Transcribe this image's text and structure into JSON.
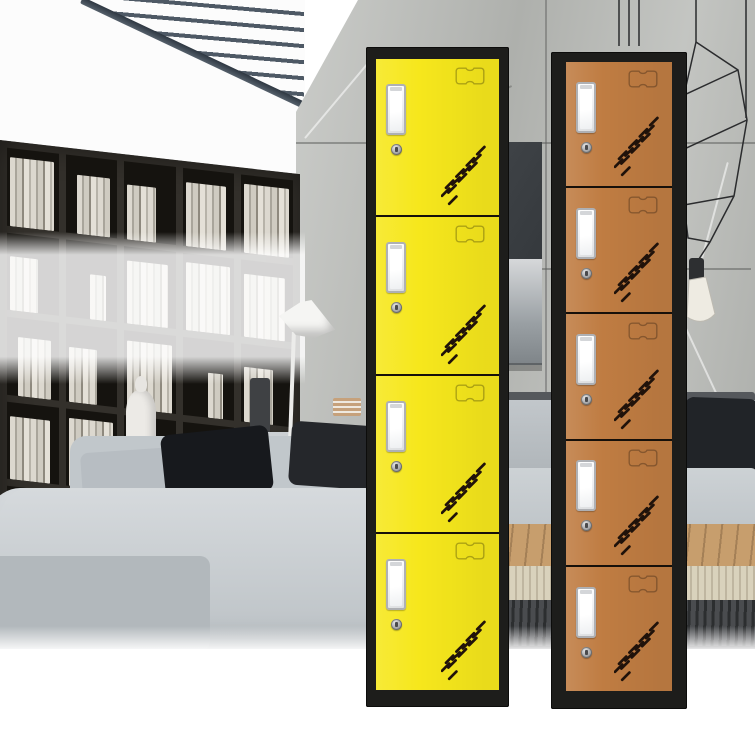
{
  "scene": {
    "setting": "modern living room interior used as product backdrop",
    "elements": [
      "ceiling-slats",
      "white-wall",
      "marble-wall",
      "bookshelf-with-books",
      "translucent-white-band",
      "floor-lamp",
      "wire-pendant-light",
      "pendant-bulb",
      "tv-panel",
      "sideboard",
      "sofa",
      "dark-cushions",
      "white-blanket",
      "wood-floor",
      "rug",
      "dark-bench",
      "white-foreground-fade"
    ]
  },
  "palette": {
    "yellow_door": "#f6e71c",
    "brown_door": "#bf7c42",
    "frame_black": "#1d1d1b",
    "vent_slot": "#20120a",
    "card_holder_border": "#aeb0b4",
    "card_holder_face": "#ffffff",
    "lock_silver": "#a9aaac",
    "marble_wall": "#b9bbb7",
    "sofa_gray": "#c2c7cb",
    "wood_floor": "#c79e6d",
    "bench_dark": "#4a4c4f",
    "ceiling_slat": "#4e5965"
  },
  "lockers": [
    {
      "id": "yellow-locker",
      "label": "yellow 4-compartment locker",
      "doors": 4,
      "door_color": "#f6e71c",
      "frame_color": "#1d1d1b",
      "door_features": [
        "card-slot",
        "keyhole-lock",
        "recessed-handle",
        "vent-slots"
      ],
      "geometry": {
        "left": 366,
        "top": 47,
        "width": 143,
        "height": 660,
        "frame": {
          "top": 12,
          "side": 10,
          "bottom": 17
        }
      }
    },
    {
      "id": "brown-locker",
      "label": "brown 5-compartment locker",
      "doors": 5,
      "door_color": "#bf7c42",
      "frame_color": "#1d1d1b",
      "door_features": [
        "card-slot",
        "keyhole-lock",
        "recessed-handle",
        "vent-slots"
      ],
      "geometry": {
        "left": 551,
        "top": 52,
        "width": 136,
        "height": 657,
        "frame": {
          "top": 10,
          "side": 15,
          "bottom": 18
        }
      }
    }
  ]
}
